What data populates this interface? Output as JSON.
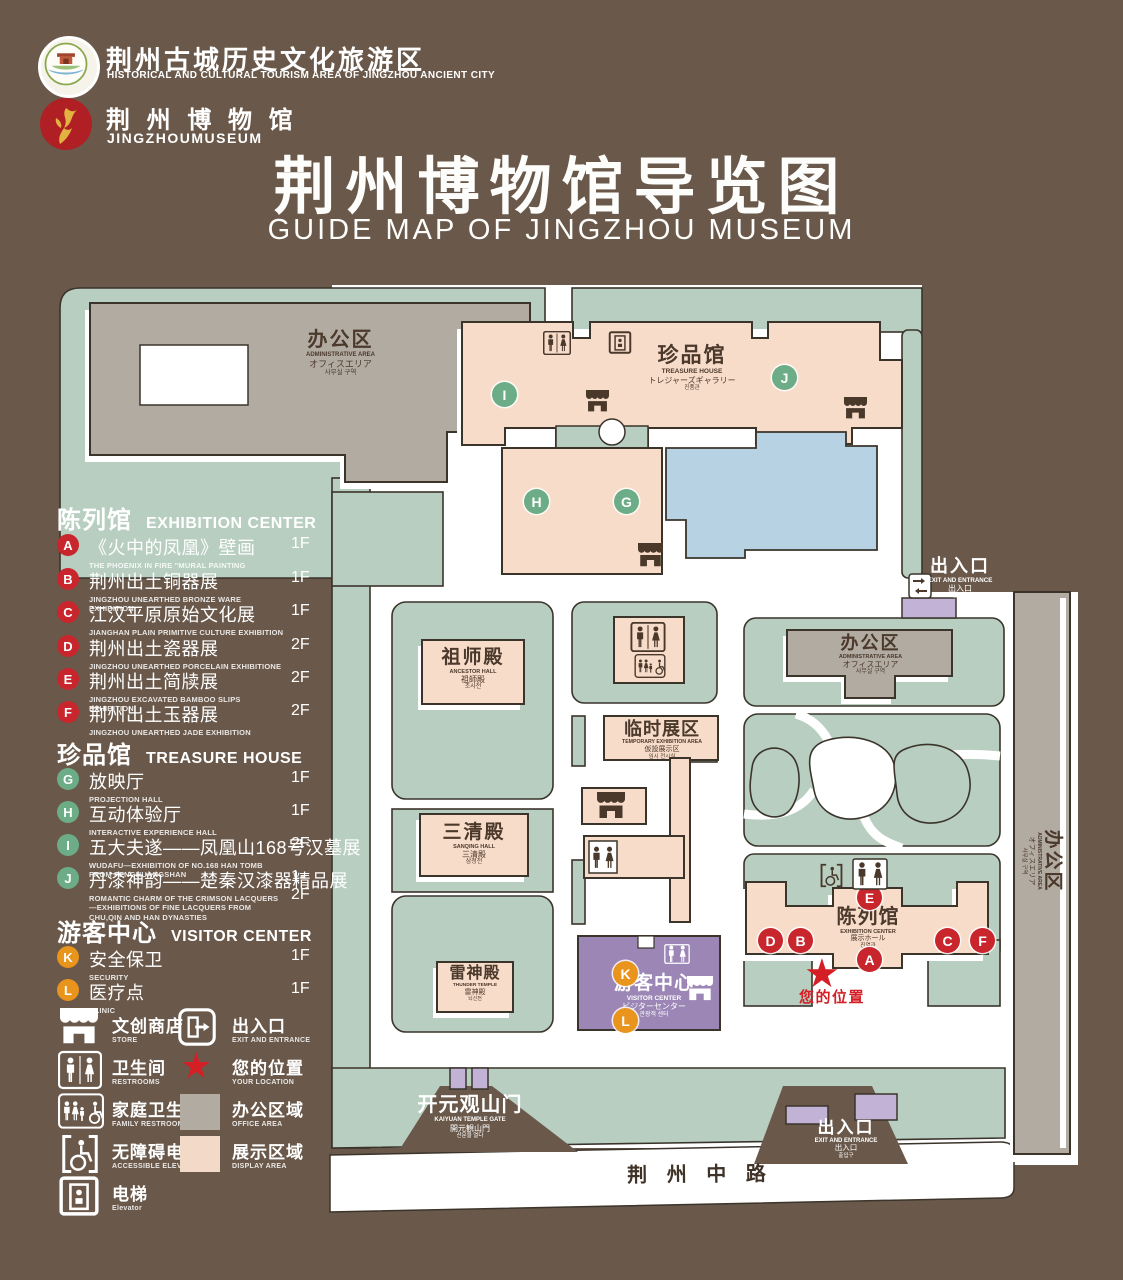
{
  "colors": {
    "background": "#6a594b",
    "lawn_green": "#b7cec0",
    "display_pink": "#f8dcca",
    "office_gray": "#b2aba2",
    "pond_blue": "#b7d2e2",
    "visitor_purple": "#9b86b5",
    "gate_purple": "#c2b3d6",
    "marker_red": "#c8252c",
    "marker_green": "#6cad88",
    "marker_orange": "#e8941d",
    "outline": "#3b342b",
    "label_brown": "#4b392b"
  },
  "icons": {
    "star": "★"
  },
  "header": {
    "tourism_logo": {
      "zh": "荆州古城历史文化旅游区",
      "en": "HISTORICAL AND CULTURAL TOURISM AREA OF JINGZHOU ANCIENT CITY"
    },
    "museum_logo": {
      "zh": "荆 州 博 物 馆",
      "en": "JINGZHOUMUSEUM"
    },
    "title_zh": "荆州博物馆导览图",
    "title_en": "GUIDE MAP OF JINGZHOU MUSEUM"
  },
  "legend": {
    "sections": [
      {
        "zh": "陈列馆",
        "en": "EXHIBITION CENTER",
        "items": [
          {
            "key": "A",
            "zh": "《火中的凤凰》壁画",
            "en": "THE PHOENIX IN FIRE \"MURAL PAINTING",
            "floor": "1F"
          },
          {
            "key": "B",
            "zh": "荆州出土铜器展",
            "en": "JINGZHOU UNEARTHED BRONZE WARE EXHIBITION",
            "floor": "1F"
          },
          {
            "key": "C",
            "zh": "江汉平原原始文化展",
            "en": "JIANGHAN PLAIN PRIMITIVE CULTURE EXHIBITION",
            "floor": "1F"
          },
          {
            "key": "D",
            "zh": "荆州出土瓷器展",
            "en": "JINGZHOU UNEARTHED PORCELAIN EXHIBITIONE",
            "floor": "2F"
          },
          {
            "key": "E",
            "zh": "荆州出土简牍展",
            "en": "JINGZHOU EXCAVATED BAMBOO SLIPS EXHIBITION",
            "floor": "2F"
          },
          {
            "key": "F",
            "zh": "荆州出土玉器展",
            "en": "JINGZHOU UNEARTHED JADE EXHIBITION",
            "floor": "2F"
          }
        ]
      },
      {
        "zh": "珍品馆",
        "en": "TREASURE HOUSE",
        "items": [
          {
            "key": "G",
            "zh": "放映厅",
            "en": "PROJECTION HALL",
            "floor": "1F"
          },
          {
            "key": "H",
            "zh": "互动体验厅",
            "en": "INTERACTIVE EXPERIENCE HALL",
            "floor": "1F"
          },
          {
            "key": "I",
            "zh": "五大夫遂——凤凰山168号汉墓展",
            "en": "WUDAFU—EXHIBITION OF NO.168 HAN TOMB FROM FENGHUANGSHAN",
            "floor": "2F"
          },
          {
            "key": "J",
            "zh": "丹漆神韵——楚秦汉漆器精品展",
            "en": "ROMANTIC CHARM OF THE CRIMSON LACQUERS—EXHIBITIONS OF FINE LACQUERS FROM CHU,QIN AND HAN DYNASTIES",
            "floor": "1-2F"
          }
        ]
      },
      {
        "zh": "游客中心",
        "en": "VISITOR CENTER",
        "items": [
          {
            "key": "K",
            "zh": "安全保卫",
            "en": "SECURITY",
            "floor": "1F"
          },
          {
            "key": "L",
            "zh": "医疗点",
            "en": "CLINIC",
            "floor": "1F"
          }
        ]
      }
    ],
    "symbols": [
      {
        "zh": "文创商店",
        "en": "STORE"
      },
      {
        "zh": "出入口",
        "en": "EXIT AND ENTRANCE"
      },
      {
        "zh": "卫生间",
        "en": "RESTROOMS"
      },
      {
        "zh": "您的位置",
        "en": "YOUR LOCATION"
      },
      {
        "zh": "家庭卫生间",
        "en": "FAMILY RESTROOMS"
      },
      {
        "zh": "办公区域",
        "en": "OFFICE AREA"
      },
      {
        "zh": "无障碍电梯",
        "en": "ACCESSIBLE ELEVATOR"
      },
      {
        "zh": "展示区域",
        "en": "DISPLAY AREA"
      },
      {
        "zh": "电梯",
        "en": "Elevator"
      }
    ]
  },
  "map": {
    "admin_nw": {
      "zh": "办公区",
      "en": "ADMINISTRATIVE AREA",
      "ja": "オフィスエリア",
      "ko": "사무실 구역"
    },
    "treasure": {
      "zh": "珍品馆",
      "en": "TREASURE HOUSE",
      "ja": "トレジャーズギャラリー",
      "ko": "진품관"
    },
    "exit_ne": {
      "zh": "出入口",
      "en": "EXIT AND ENTRANCE",
      "ja": "出入口",
      "ko": "출입구"
    },
    "admin_mid": {
      "zh": "办公区",
      "en": "ADMINISTRATIVE AREA",
      "ja": "オフィスエリア",
      "ko": "사무실 구역"
    },
    "admin_east": {
      "zh": "办公区",
      "en": "ADMINISTRATIVE AREA",
      "ja": "オフィスエリア",
      "ko": "사무실 구역"
    },
    "ancestor": {
      "zh": "祖师殿",
      "en": "ANCESTOR HALL",
      "ja": "祖師殿",
      "ko": "조사전"
    },
    "temporary": {
      "zh": "临时展区",
      "en": "TEMPORARY EXHIBITION AREA",
      "ja": "仮設展示区",
      "ko": "임시 전시실"
    },
    "sanqing": {
      "zh": "三清殿",
      "en": "SANQING HALL",
      "ja": "三清殿",
      "ko": "삼청전"
    },
    "thunder": {
      "zh": "雷神殿",
      "en": "THUNDER TEMPLE",
      "ja": "雷神殿",
      "ko": "뇌신전"
    },
    "visitor": {
      "zh": "游客中心",
      "en": "VISITOR CENTER",
      "ja": "ビジターセンター",
      "ko": "관광객 센터"
    },
    "exhibition": {
      "zh": "陈列馆",
      "en": "EXHIBITION CENTER",
      "ja": "展示ホール",
      "ko": "진열관"
    },
    "gate": {
      "zh": "开元观山门",
      "en": "KAIYUAN TEMPLE GATE",
      "ja": "開元観山門",
      "ko": "산문을 열다"
    },
    "exit_s": {
      "zh": "出入口",
      "en": "EXIT AND ENTRANCE",
      "ja": "出入口",
      "ko": "출입구"
    },
    "your_location": "您的位置",
    "road": "荆 州 中 路",
    "markers": {
      "A": "A",
      "B": "B",
      "C": "C",
      "D": "D",
      "E": "E",
      "F": "F",
      "G": "G",
      "H": "H",
      "I": "I",
      "J": "J",
      "K": "K",
      "L": "L"
    }
  }
}
